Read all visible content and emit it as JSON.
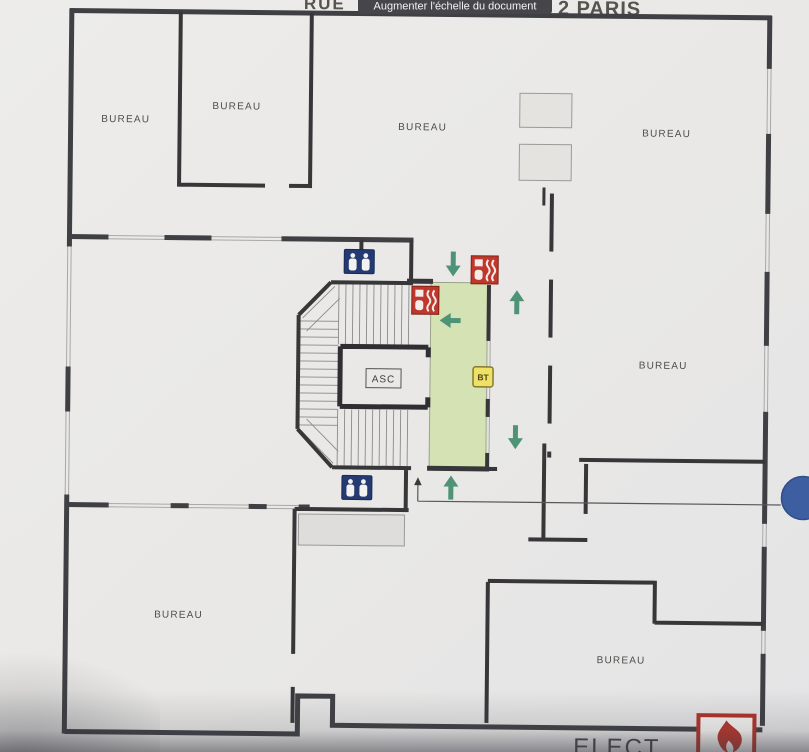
{
  "viewer": {
    "tooltip_label": "Augmenter l'échelle du document",
    "header_left_fragment": "RUE",
    "header_right_fragment": "2 PARIS"
  },
  "plan": {
    "rooms": [
      {
        "id": "bureau-top-left",
        "label": "BUREAU"
      },
      {
        "id": "bureau-top-mid",
        "label": "BUREAU"
      },
      {
        "id": "bureau-top-center",
        "label": "BUREAU"
      },
      {
        "id": "bureau-top-right",
        "label": "BUREAU"
      },
      {
        "id": "bureau-mid-right",
        "label": "BUREAU"
      },
      {
        "id": "bureau-bottom-left",
        "label": "BUREAU"
      },
      {
        "id": "bureau-bottom-right",
        "label": "BUREAU"
      }
    ],
    "elevator_label": "ASC",
    "bt_box_label": "BT",
    "elect_label": "ELECT",
    "icons": {
      "wc_icon": "restroom-pictogram",
      "fire_equipment_icon": "fire-extinguisher-point",
      "bt_electrical_icon": "low-voltage-panel",
      "flame_icon": "fire-risk-flame",
      "exit_route_arrows": "green-evacuation-arrows",
      "marker_dot": "blue-annotation-marker"
    },
    "colors": {
      "escape_route_green": "#d5e2b4",
      "arrow_green": "#4f9377",
      "fire_red": "#c0372c",
      "wc_navy": "#263a72",
      "bt_yellow": "#efe066",
      "marker_blue": "#3d5ea1",
      "wall_dark": "#3f4044"
    }
  }
}
